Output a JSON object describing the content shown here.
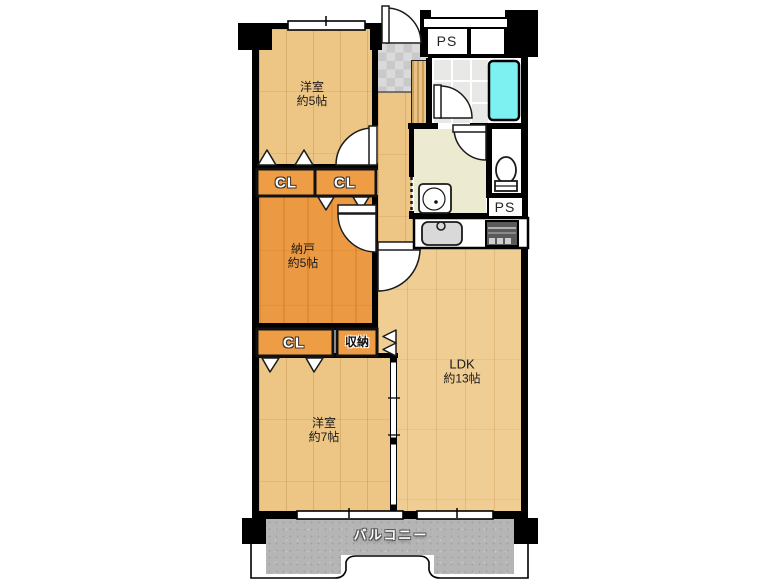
{
  "plan": {
    "rooms": {
      "bedroom5": {
        "name": "洋室",
        "size": "約5帖"
      },
      "storage_room": {
        "name": "納戸",
        "size": "約5帖"
      },
      "bedroom7": {
        "name": "洋室",
        "size": "約7帖"
      },
      "ldk": {
        "name": "LDK",
        "size": "約13帖"
      },
      "balcony": {
        "name": "バルコニー"
      }
    },
    "closets": [
      {
        "label": "CL"
      },
      {
        "label": "CL"
      },
      {
        "label": "CL"
      },
      {
        "label": "収納"
      }
    ],
    "pipe_spaces": [
      {
        "label": "PS"
      },
      {
        "label": "PS"
      }
    ],
    "colors": {
      "wall": "#000000",
      "wood_bedroom": "#edc584",
      "wood_ldk": "#f0cd92",
      "storage_orange": "#eb9a43",
      "closet_orange": "#ef9d45",
      "bathtub_cyan": "#7df0f2",
      "washroom_cream": "#edead2",
      "balcony_gray": "#b5b5b5"
    }
  }
}
